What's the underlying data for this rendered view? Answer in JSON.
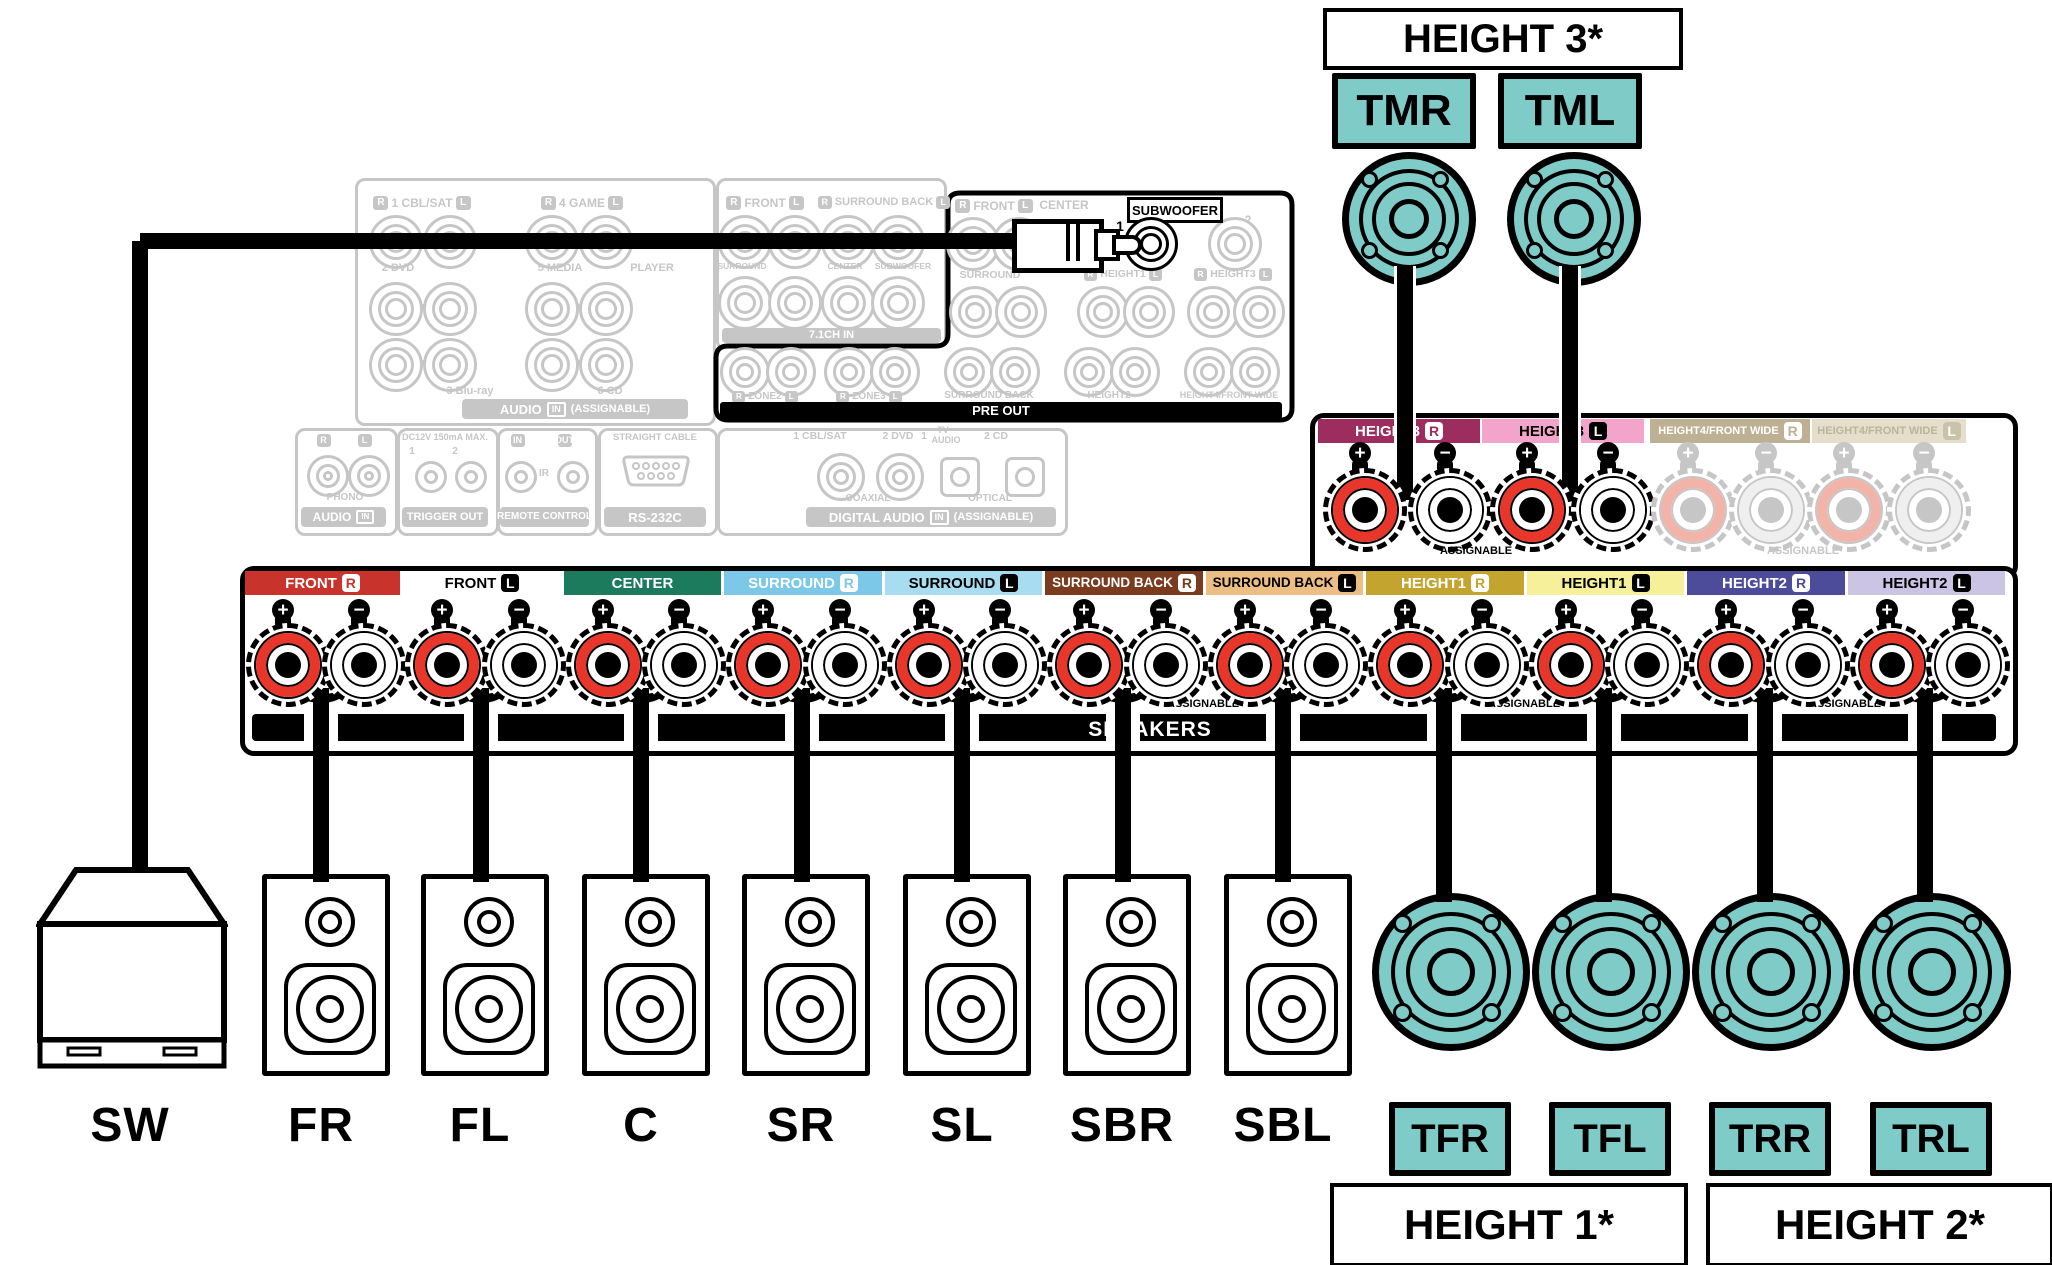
{
  "colors": {
    "teal": "#7fcbc8",
    "terminal_red": "#e8362a",
    "terminal_red_pale": "#f2b4a9",
    "inactive_gray": "#c6c6c6",
    "cable_black": "#000000"
  },
  "top_right": {
    "height3_label": "HEIGHT 3*",
    "tmr_label": "TMR",
    "tml_label": "TML"
  },
  "receiver": {
    "analog_box": {
      "row1_labels": [
        {
          "l": "R",
          "text": "1 CBL/SAT",
          "r": "L"
        },
        {
          "l": "R",
          "text": "4 GAME",
          "r": "L"
        }
      ],
      "row2_labels": [
        "2 DVD",
        "5 MEDIA",
        "PLAYER"
      ],
      "row3_labels": [
        "3 Blu-ray",
        "6 CD"
      ],
      "bar": {
        "main": "AUDIO",
        "badge": "IN",
        "suffix": "(ASSIGNABLE)"
      }
    },
    "ch71_box": {
      "row1_labels": [
        {
          "l": "R",
          "text": "FRONT",
          "r": "L"
        },
        {
          "l": "R",
          "text": "SURROUND BACK",
          "r": "L"
        }
      ],
      "row2_labels": [
        "SURROUND",
        "CENTER",
        "SUBWOOFER"
      ],
      "bar": "7.1CH IN"
    },
    "preout_box": {
      "row1_labels": [
        {
          "l": "R",
          "text": "FRONT",
          "r": "L"
        },
        {
          "text": "CENTER"
        }
      ],
      "subwoofer_label": "SUBWOOFER",
      "jack1_label": "1",
      "jack2_label": "2",
      "row2_labels": [
        {
          "text": "SURROUND"
        },
        {
          "l": "R",
          "text": "HEIGHT1",
          "r": "L"
        },
        {
          "l": "R",
          "text": "HEIGHT3",
          "r": "L"
        }
      ],
      "row3_labels": [
        {
          "l": "R",
          "text": "ZONE2",
          "r": "L"
        },
        {
          "l": "R",
          "text": "ZONE3",
          "r": "L"
        },
        {
          "text": "SURROUND BACK"
        },
        {
          "text": "HEIGHT2"
        },
        {
          "text": "HEIGHT4/FRONT WIDE"
        }
      ],
      "bar": "PRE OUT"
    },
    "phono_box": {
      "r": "R",
      "l": "L",
      "name": "PHONO",
      "bar": {
        "main": "AUDIO",
        "badge": "IN"
      }
    },
    "trigger_box": {
      "top": "DC12V 150mA MAX.",
      "n1": "1",
      "n2": "2",
      "bar": "TRIGGER OUT"
    },
    "remote_box": {
      "in": "IN",
      "out": "OUT",
      "ir": "IR",
      "bar": "REMOTE CONTROL"
    },
    "rs232_box": {
      "top": "STRAIGHT CABLE",
      "bar": "RS-232C"
    },
    "digital_box": {
      "labels": [
        "1 CBL/SAT",
        "2 DVD",
        "1",
        "TV",
        "AUDIO",
        "2 CD"
      ],
      "coaxial": "COAXIAL",
      "optical": "OPTICAL",
      "bar": {
        "main": "DIGITAL AUDIO",
        "badge": "IN",
        "suffix": "(ASSIGNABLE)"
      }
    }
  },
  "speaker_strip": {
    "sections": [
      {
        "label": "FRONT",
        "badge": "R",
        "bg": "#c8342b",
        "fg": "#ffffff",
        "badge_style": "light"
      },
      {
        "label": "FRONT",
        "badge": "L",
        "bg": "#ffffff",
        "fg": "#000000",
        "badge_style": "dark"
      },
      {
        "label": "CENTER",
        "badge": null,
        "bg": "#1b7b5c",
        "fg": "#ffffff",
        "badge_style": "light"
      },
      {
        "label": "SURROUND",
        "badge": "R",
        "bg": "#7cc8e8",
        "fg": "#ffffff",
        "badge_style": "light"
      },
      {
        "label": "SURROUND",
        "badge": "L",
        "bg": "#a8dcf0",
        "fg": "#000000",
        "badge_style": "dark"
      },
      {
        "label": "SURROUND BACK",
        "badge": "R",
        "bg": "#7a3b1e",
        "fg": "#ffffff",
        "badge_style": "light"
      },
      {
        "label": "SURROUND BACK",
        "badge": "L",
        "bg": "#ecbe83",
        "fg": "#000000",
        "badge_style": "dark"
      },
      {
        "label": "HEIGHT1",
        "badge": "R",
        "bg": "#c3a42f",
        "fg": "#ffffff",
        "badge_style": "light"
      },
      {
        "label": "HEIGHT1",
        "badge": "L",
        "bg": "#f7f09b",
        "fg": "#000000",
        "badge_style": "dark"
      },
      {
        "label": "HEIGHT2",
        "badge": "R",
        "bg": "#4d4c9b",
        "fg": "#ffffff",
        "badge_style": "light"
      },
      {
        "label": "HEIGHT2",
        "badge": "L",
        "bg": "#cbc4e4",
        "fg": "#000000",
        "badge_style": "dark"
      }
    ],
    "assignable_label": "ASSIGNABLE",
    "speakers_label": "SPEAKERS",
    "plus_glyph": "+",
    "minus_glyph": "−"
  },
  "height3_panel": {
    "sections": [
      {
        "label": "HEIGHT3",
        "badge": "R",
        "bg": "#9c2d5e",
        "fg": "#ffffff",
        "badge_style": "light",
        "active": true
      },
      {
        "label": "HEIGHT3",
        "badge": "L",
        "bg": "#f2a4ca",
        "fg": "#000000",
        "badge_style": "dark",
        "active": true
      },
      {
        "label": "HEIGHT4/FRONT WIDE",
        "badge": "R",
        "bg": "#beb193",
        "fg": "#ffffff",
        "badge_style": "light",
        "active": false
      },
      {
        "label": "HEIGHT4/FRONT WIDE",
        "badge": "L",
        "bg": "#e4decb",
        "fg": "#bab49b",
        "badge_style": "pale",
        "active": false
      }
    ],
    "assignable_active": "ASSIGNABLE",
    "assignable_inactive": "ASSIGNABLE"
  },
  "bottom": {
    "speaker_labels": [
      "SW",
      "FR",
      "FL",
      "C",
      "SR",
      "SL",
      "SBR",
      "SBL"
    ],
    "teal_badges": [
      "TFR",
      "TFL",
      "TRR",
      "TRL"
    ],
    "height1_label": "HEIGHT 1*",
    "height2_label": "HEIGHT 2*"
  }
}
